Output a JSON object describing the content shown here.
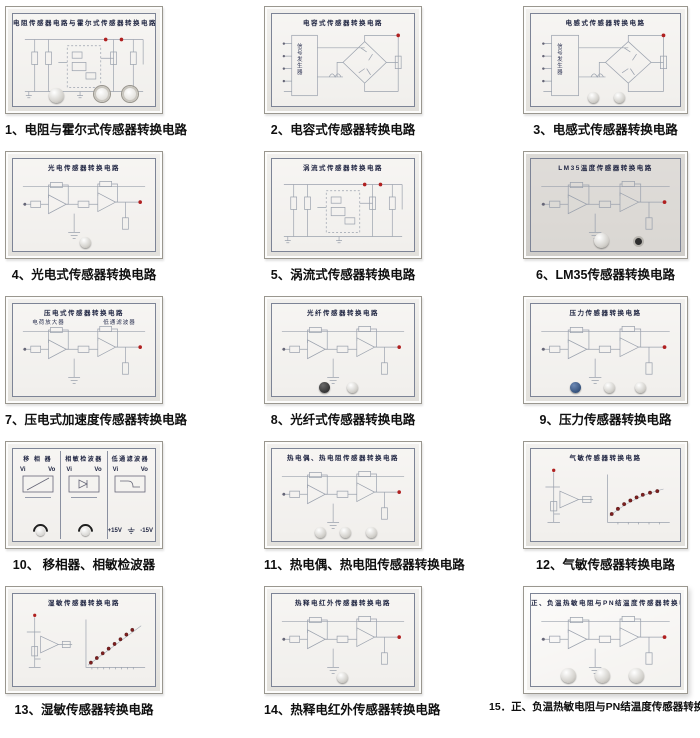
{
  "labels": {
    "signal_generator": "信号发生器"
  },
  "colors": {
    "terminal_red": "#b02020",
    "curve_dot": "#7d1f1f",
    "panel_frame": "#e9e7e2",
    "panel_gray": "#d8d6d2"
  },
  "panels": [
    {
      "num": "1",
      "title": "电阻传感器电路与霍尔式传感器转换电路",
      "caption": "1、电阻与霍尔式传感器转换电路"
    },
    {
      "num": "2",
      "title": "电容式传感器转换电路",
      "caption": "2、电容式传感器转换电路"
    },
    {
      "num": "3",
      "title": "电感式传感器转换电路",
      "caption": "3、电感式传感器转换电路"
    },
    {
      "num": "4",
      "title": "光电传感器转换电路",
      "caption": "4、光电式传感器转换电路"
    },
    {
      "num": "5",
      "title": "涡流式传感器转换电路",
      "caption": "5、涡流式传感器转换电路"
    },
    {
      "num": "6",
      "title": "LM35温度传感器转换电路",
      "caption": "6、LM35传感器转换电路"
    },
    {
      "num": "7",
      "title": "压电式传感器转换电路",
      "caption": "7、压电式加速度传感器转换电路",
      "stage_labels": [
        "电荷放大器",
        "低通滤波器"
      ]
    },
    {
      "num": "8",
      "title": "光纤传感器转换电路",
      "caption": "8、光纤式传感器转换电路"
    },
    {
      "num": "9",
      "title": "压力传感器转换电路",
      "caption": "9、压力传感器转换电路"
    },
    {
      "num": "10",
      "caption": "10、 移相器、相敏检波器",
      "sections": [
        {
          "title": "移 相 器",
          "vin": "Vi",
          "vout": "Vo"
        },
        {
          "title": "相敏检波器",
          "vin": "Vi",
          "vout": "Vo"
        },
        {
          "title": "低通滤波器",
          "vin": "Vi",
          "vout": "Vo"
        }
      ],
      "power": {
        "pos": "+15V",
        "neg": "-15V"
      }
    },
    {
      "num": "11",
      "title": "热电偶、热电阻传感器转换电路",
      "caption": "11、热电偶、热电阻传感器转换电路"
    },
    {
      "num": "12",
      "title": "气敏传感器转换电路",
      "caption": "12、气敏传感器转换电路"
    },
    {
      "num": "13",
      "title": "湿敏传感器转换电路",
      "caption": "13、湿敏传感器转换电路"
    },
    {
      "num": "14",
      "title": "热释电红外传感器转换电路",
      "caption": "14、热释电红外传感器转换电路"
    },
    {
      "num": "15",
      "title": "正、负温热敏电阻与PN结温度传感器转换电路",
      "caption": "15．正、负温热敏电阻与PN结温度传感器转换电路"
    }
  ]
}
